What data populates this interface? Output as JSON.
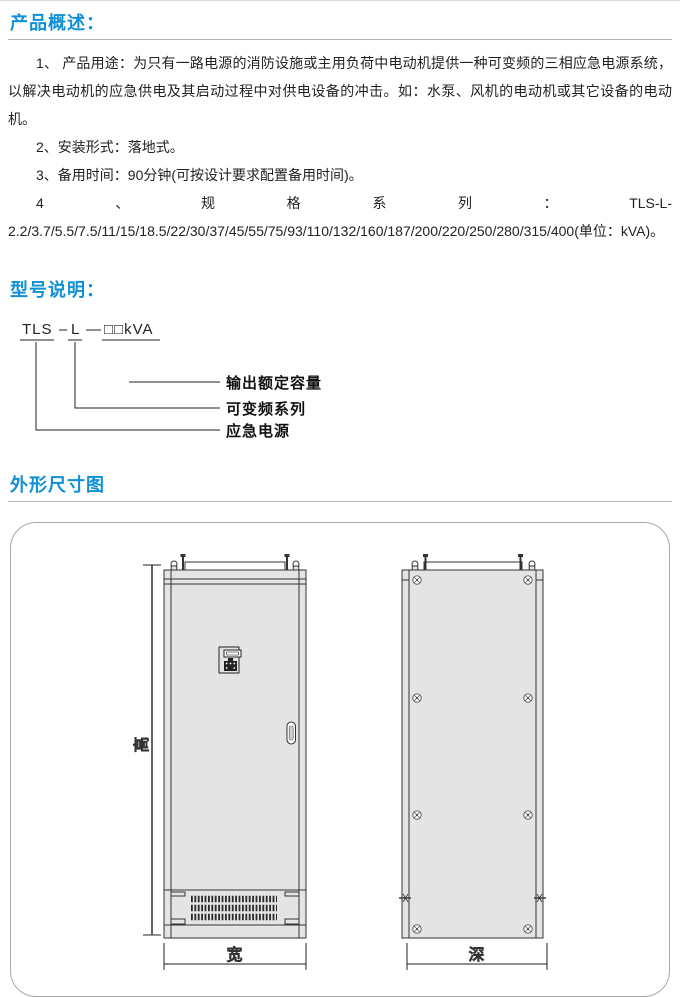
{
  "colors": {
    "accent_blue": "#1090d8",
    "divider_gray": "#b3b3b3",
    "cabinet_fill": "#e4e4e4",
    "line_color": "#333333"
  },
  "sections": {
    "overview": {
      "title": "产品概述：",
      "paragraphs": [
        "1、 产品用途：为只有一路电源的消防设施或主用负荷中电动机提供一种可变频的三相应急电源系统，以解决电动机的应急供电及其启动过程中对供电设备的冲击。如：水泵、风机的电动机或其它设备的电动机。",
        "2、安装形式：落地式。",
        "3、备用时间：90分钟(可按设计要求配置备用时间)。",
        "4、规格系列：TLS-L-2.2/3.7/5.5/7.5/11/15/18.5/22/30/37/45/55/75/93/110/132/160/187/200/220/250/280/315/400(单位：kVA)。"
      ]
    },
    "model": {
      "title": "型号说明：",
      "code": {
        "part1": "TLS",
        "dash1": "–",
        "part2": "L",
        "dash2": "—",
        "part3": "□□kVA"
      },
      "callouts": {
        "capacity": "输出额定容量",
        "series": "可变频系列",
        "eps": "应急电源"
      }
    },
    "dimensions": {
      "title": "外形尺寸图",
      "labels": {
        "height": "高",
        "width": "宽",
        "depth": "深"
      }
    }
  }
}
